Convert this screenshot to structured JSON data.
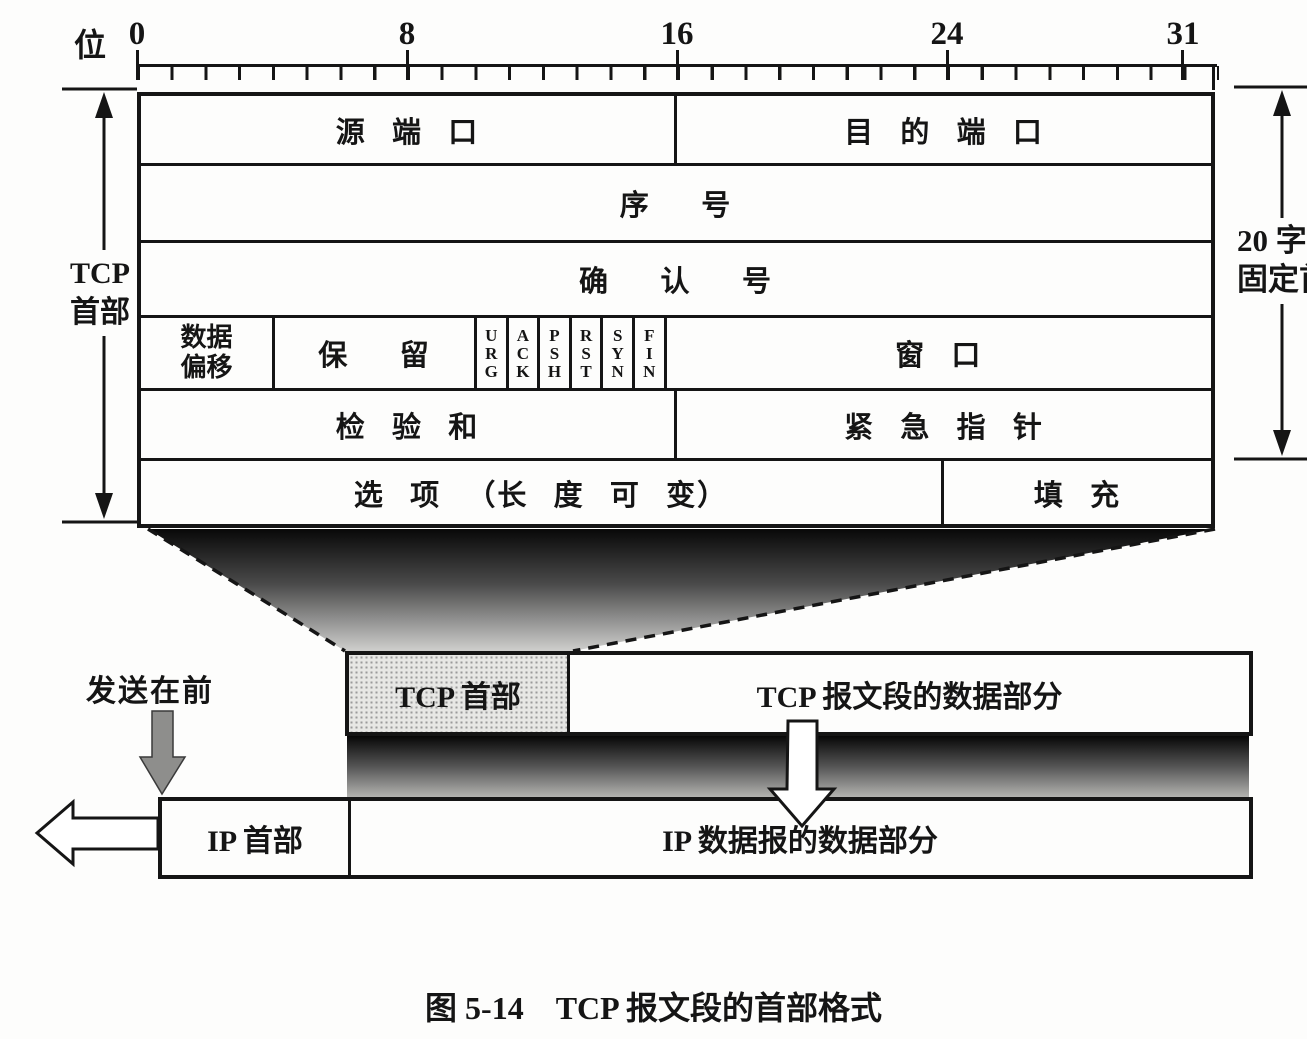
{
  "figure": {
    "bit_axis": {
      "unit": "位",
      "labels": [
        "0",
        "8",
        "16",
        "24",
        "31"
      ]
    },
    "tcp_header_table": {
      "source_port": "源 端 口",
      "dest_port": "目 的 端 口",
      "seq_no": "序  号",
      "ack_no": "确  认  号",
      "data_offset_line1": "数据",
      "data_offset_line2": "偏移",
      "reserved": "保  留",
      "flags": [
        "URG",
        "ACK",
        "PSH",
        "RST",
        "SYN",
        "FIN"
      ],
      "window": "窗 口",
      "checksum": "检 验 和",
      "urgent_pointer": "紧 急 指 针",
      "options": "选 项 （长 度 可 变）",
      "padding": "填 充"
    },
    "left_brace_label": {
      "line1": "TCP",
      "line2": "首部"
    },
    "right_brace_label": {
      "line1": "20 字节",
      "line2": "固定首部"
    },
    "segment_row": {
      "header": "TCP 首部",
      "data": "TCP 报文段的数据部分"
    },
    "ip_row": {
      "header": "IP 首部",
      "data": "IP 数据报的数据部分"
    },
    "send_first": "发送在前",
    "caption": "图 5-14　TCP 报文段的首部格式"
  }
}
